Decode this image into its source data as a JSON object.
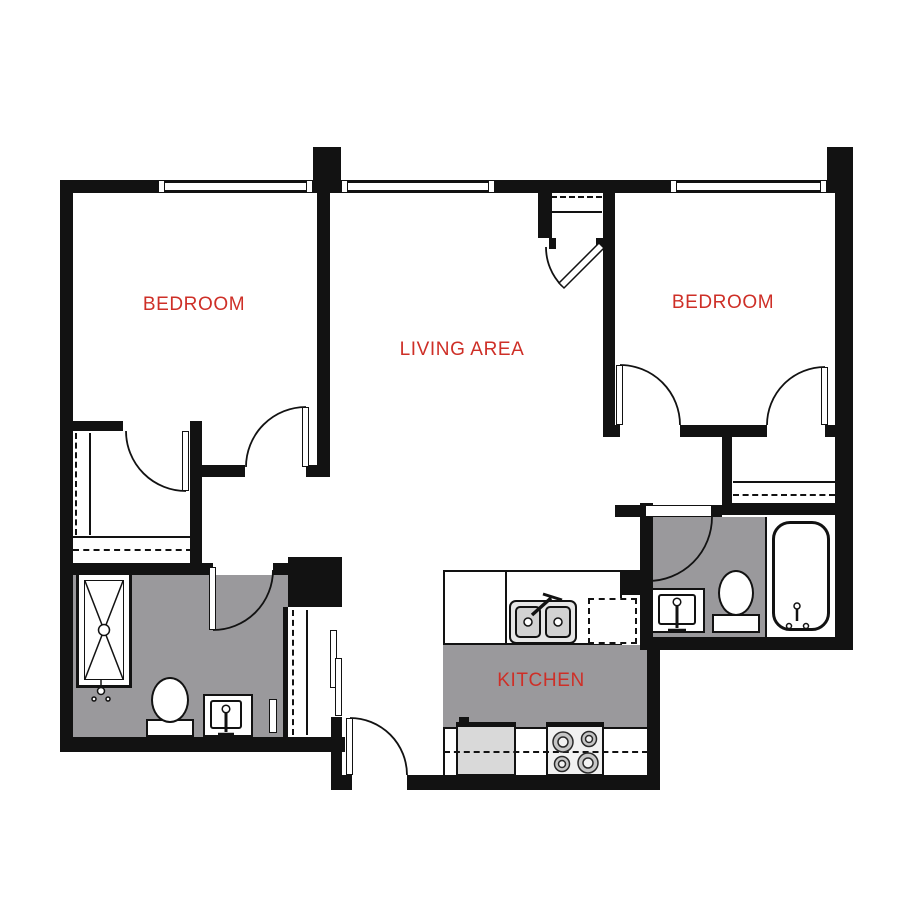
{
  "rooms": [
    {
      "id": "bedroom-left",
      "label": "BEDROOM"
    },
    {
      "id": "living-area",
      "label": "LIVING AREA"
    },
    {
      "id": "bedroom-right",
      "label": "BEDROOM"
    },
    {
      "id": "kitchen",
      "label": "KITCHEN"
    }
  ],
  "colors": {
    "wall": "#121212",
    "label": "#ce2f27",
    "floor": "#9a999c",
    "appliance": "#d9d9d9",
    "basin": "#d2d2d2",
    "sink_body": "#e6e6e6",
    "stove_body": "#f1f1f1",
    "background": "#ffffff"
  },
  "fixtures": {
    "bathroom_left": [
      "shower",
      "toilet",
      "vanity-sink"
    ],
    "bathroom_right": [
      "vanity-sink",
      "toilet",
      "bathtub"
    ],
    "kitchen": [
      "double-sink",
      "faucet",
      "dishwasher-dashed",
      "refrigerator",
      "stove-4-burner",
      "upper-cabinet-dashed-line"
    ],
    "closets": [
      "walk-in-closet",
      "entry-coat-closet",
      "sliding-door-closet",
      "bedroom-right-closet"
    ]
  }
}
